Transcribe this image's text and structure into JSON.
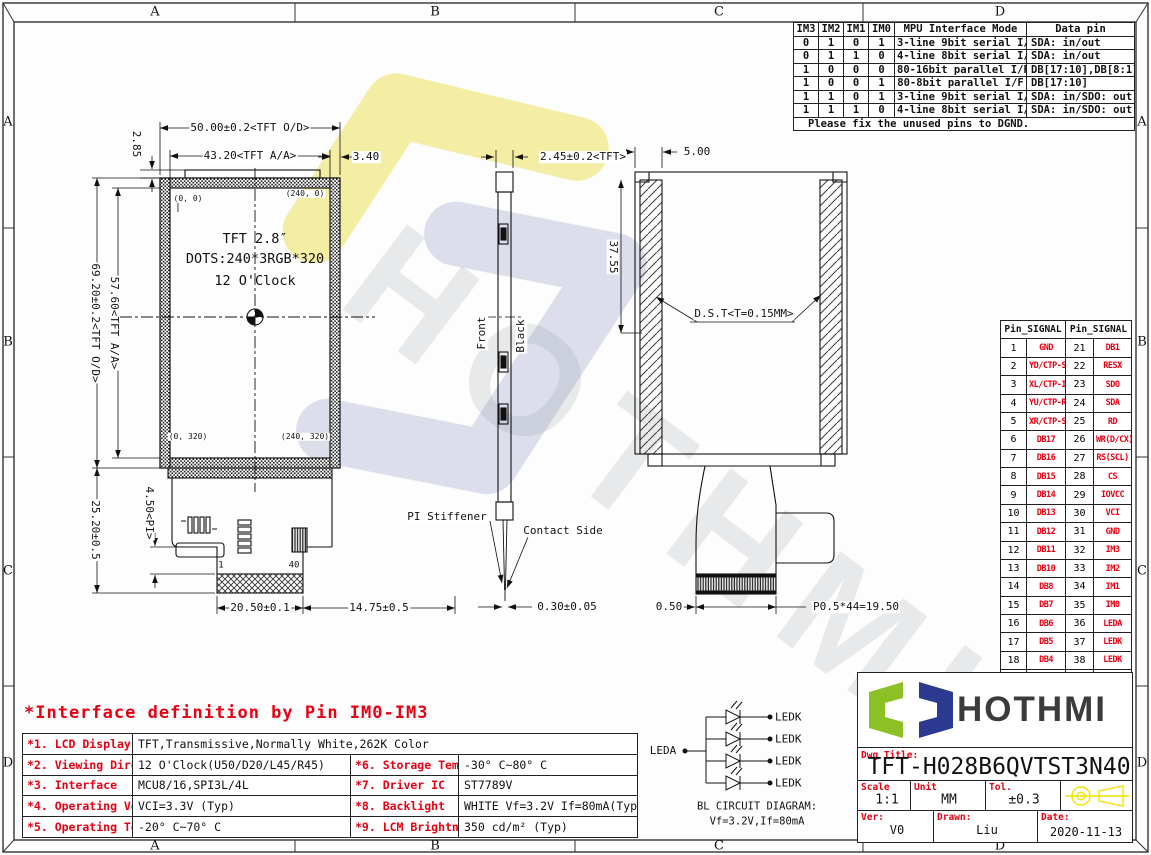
{
  "frame": {
    "zones_h": [
      "A",
      "B",
      "C",
      "D"
    ],
    "zones_v": [
      "A",
      "B",
      "C",
      "D"
    ]
  },
  "im_table": {
    "headers": [
      "IM3",
      "IM2",
      "IM1",
      "IM0",
      "MPU Interface Mode",
      "Data pin"
    ],
    "rows": [
      [
        "0",
        "1",
        "0",
        "1",
        "3-line 9bit serial I/F",
        "SDA: in/out"
      ],
      [
        "0",
        "1",
        "1",
        "0",
        "4-line 8bit serial I/F",
        "SDA: in/out"
      ],
      [
        "1",
        "0",
        "0",
        "0",
        "80-16bit parallel I/F",
        "DB[17:10],DB[8:1]"
      ],
      [
        "1",
        "0",
        "0",
        "1",
        "80-8bit parallel I/F",
        "DB[17:10]"
      ],
      [
        "1",
        "1",
        "0",
        "1",
        "3-line 9bit serial I/F Ⅱ",
        "SDA: in/SDO: out"
      ],
      [
        "1",
        "1",
        "1",
        "0",
        "4-line 8bit serial I/F Ⅱ",
        "SDA: in/SDO: out"
      ]
    ],
    "footer": "Please fix the unused pins to DGND."
  },
  "pin_table": {
    "headers": [
      "Pin_SIGNAL",
      "Pin_SIGNAL"
    ],
    "rows": [
      [
        "1",
        "GND",
        "21",
        "DB1"
      ],
      [
        "2",
        "YD/CTP-SDA",
        "22",
        "RESX"
      ],
      [
        "3",
        "XL/CTP-INT",
        "23",
        "SDO"
      ],
      [
        "4",
        "YU/CTP-RES",
        "24",
        "SDA"
      ],
      [
        "5",
        "XR/CTP-SCL",
        "25",
        "RD"
      ],
      [
        "6",
        "DB17",
        "26",
        "WR(D/CX)"
      ],
      [
        "7",
        "DB16",
        "27",
        "RS(SCL)"
      ],
      [
        "8",
        "DB15",
        "28",
        "CS"
      ],
      [
        "9",
        "DB14",
        "29",
        "IOVCC"
      ],
      [
        "10",
        "DB13",
        "30",
        "VCI"
      ],
      [
        "11",
        "DB12",
        "31",
        "GND"
      ],
      [
        "12",
        "DB11",
        "32",
        "IM3"
      ],
      [
        "13",
        "DB10",
        "33",
        "IM2"
      ],
      [
        "14",
        "DB8",
        "34",
        "IM1"
      ],
      [
        "15",
        "DB7",
        "35",
        "IM0"
      ],
      [
        "16",
        "DB6",
        "36",
        "LEDA"
      ],
      [
        "17",
        "DB5",
        "37",
        "LEDK"
      ],
      [
        "18",
        "DB4",
        "38",
        "LEDK"
      ],
      [
        "19",
        "DB3",
        "39",
        "LEDK"
      ],
      [
        "20",
        "DB2",
        "40",
        "LEDK"
      ]
    ]
  },
  "plan_view": {
    "dim_od_w": "50.00±0.2<TFT O/D>",
    "dim_aa_w": "43.20<TFT A/A>",
    "dim_margin_r": "3.40",
    "dim_top": "2.85",
    "dim_aa_h": "57.60<TFT A/A>",
    "dim_od_h": "69.20±0.2<TFT O/D>",
    "dim_fpc_h": "25.20±0.5",
    "dim_pi": "4.50<PI>",
    "dim_conn_w": "20.50±0.1",
    "dim_conn_off": "14.75±0.5",
    "corner_tl": "(0, 0)",
    "corner_tr": "(240, 0)",
    "corner_bl": "(0, 320)",
    "corner_br": "(240, 320)",
    "line1": "TFT 2.8″",
    "line2": "DOTS:240*3RGB*320",
    "line3": "12 O'Clock",
    "pin1": "1",
    "pin40": "40"
  },
  "side_view": {
    "dim_thk": "2.45±0.2<TFT>",
    "front": "Front",
    "black": "Black",
    "pi_stiffener": "PI Stiffener",
    "contact_side": "Contact Side",
    "dim_tail": "0.30±0.05"
  },
  "back_view": {
    "dim_edge": "5.00",
    "dim_h": "37.55",
    "dst": "D.S.T<T=0.15MM>",
    "dim_half": "0.50",
    "dim_pitch": "P0.5*44=19.50"
  },
  "bl_circuit": {
    "leda": "LEDA",
    "ledk": "LEDK",
    "caption1": "BL CIRCUIT DIAGRAM:",
    "caption2": "Vf=3.2V,If=80mA"
  },
  "spec": {
    "title": "*Interface definition by Pin IM0-IM3",
    "rows": [
      {
        "l": "*1. LCD Display Type",
        "v": "TFT,Transmissive,Normally White,262K Color",
        "l2": "",
        "v2": ""
      },
      {
        "l": "*2. Viewing Diretion",
        "v": "12 O'Clock(U50/D20/L45/R45)",
        "l2": "*6. Storage Temp",
        "v2": "-30° C~80° C"
      },
      {
        "l": "*3. Interface",
        "v": "MCU8/16,SPI3L/4L",
        "l2": "*7. Driver IC",
        "v2": "ST7789V"
      },
      {
        "l": "*4. Operating Voltage",
        "v": "VCI=3.3V (Typ)",
        "l2": "*8. Backlight",
        "v2": "WHITE Vf=3.2V If=80mA(Typ)"
      },
      {
        "l": "*5. Operating Temp",
        "v": "-20° C~70° C",
        "l2": "*9. LCM Brightness",
        "v2": "350 cd/m² (Typ)"
      }
    ]
  },
  "title_block": {
    "brand": "HOTHMI",
    "dwg_label": "Dwg Title:",
    "dwg_no": "TFT-H028B6QVTST3N40",
    "scale_label": "Scale",
    "scale": "1:1",
    "unit_label": "Unit",
    "unit": "MM",
    "tol_label": "Tol.",
    "tol": "±0.3",
    "ver_label": "Ver:",
    "ver": "V0",
    "drawn_label": "Drawn:",
    "drawn": "Liu",
    "date_label": "Date:",
    "date": "2020-11-13"
  },
  "colors": {
    "red": "#e60012",
    "yellow": "#f0e400",
    "logo_green": "#8bc125",
    "logo_navy": "#2b3990"
  }
}
